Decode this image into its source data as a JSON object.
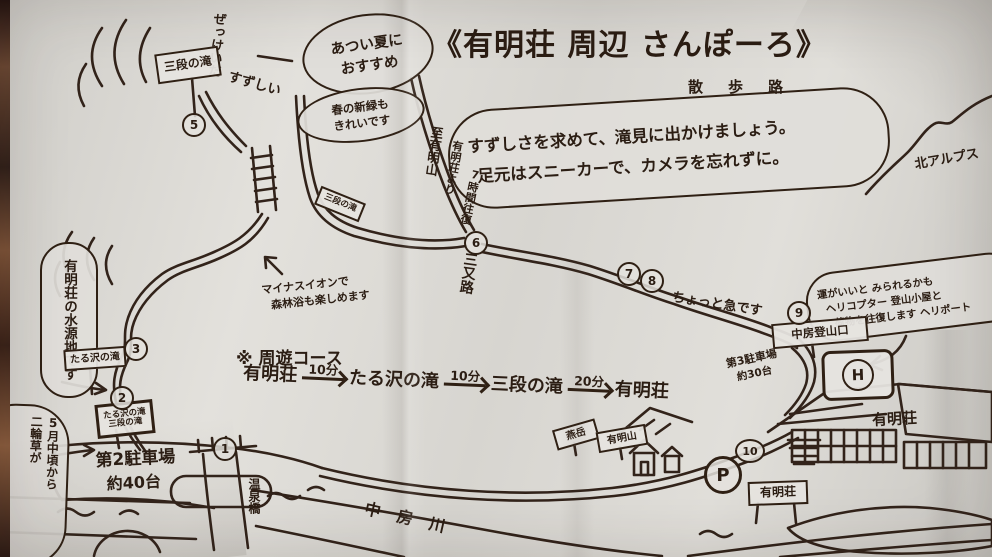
{
  "colors": {
    "ink": "#32231a",
    "paper": "#d9d7d2",
    "photo_edge": "#5d3d2c"
  },
  "title": {
    "main": "《有明荘 周辺 さんぽーろ》",
    "reading": "散　歩　路"
  },
  "intro_bubble": {
    "line1": "すずしさを求めて、滝見に出かけましょう。",
    "line2": "足元はスニーカーで、カメラを忘れずに。"
  },
  "notes": {
    "summer_line1": "あつい夏に",
    "summer_line2": "おすすめ",
    "spring_line1": "春の新緑も",
    "spring_line2": "きれいです",
    "zekkei": "ぜっけいだ",
    "suzushii": "すずしい",
    "minus_ion_line1": "マイナスイオンで",
    "minus_ion_line2": "森林浴も楽しめます",
    "steep": "ちょっと急です",
    "water_source": "有明荘の水源地です",
    "nirinso_line1": "5月中頃から",
    "nirinso_line2": "二輪草が",
    "heli_line1": "運がいいと みられるかも",
    "heli_line2": "ヘリコプター 登山小屋と",
    "heli_line3": "荷物を往復します ヘリポート"
  },
  "course": {
    "heading": "※ 周遊コース",
    "steps": [
      "有明荘",
      "たる沢の滝",
      "三段の滝",
      "有明荘"
    ],
    "durations": [
      "10分",
      "10分",
      "20分"
    ]
  },
  "signs": {
    "sandan_top": "三段の滝",
    "sandan_small": "三段の滝",
    "tarusawa": "たる沢の滝",
    "double_line1": "たる沢の滝",
    "double_line2": "三段の滝",
    "to_ariakeyama": "至有明山",
    "ariakeyama_from": "有明荘より",
    "ariakeyama_time": "7時間往復",
    "sansaro": "三又路",
    "tozanguchi": "中房登山口",
    "tsubakuro": "燕岳",
    "ariakeyama": "有明山",
    "gate": "有明荘"
  },
  "labels": {
    "parking2_line1": "第2駐車場",
    "parking2_line2": "約40台",
    "parking3_line1": "第3駐車場",
    "parking3_line2": "約30台",
    "river": "中房川",
    "bridge": "温泉橋",
    "alps": "北アルプス",
    "lodge": "有明荘",
    "helipad": "H",
    "parking_mark": "P"
  },
  "waypoints": [
    "1",
    "2",
    "3",
    "5",
    "6",
    "7",
    "8",
    "9",
    "10"
  ]
}
